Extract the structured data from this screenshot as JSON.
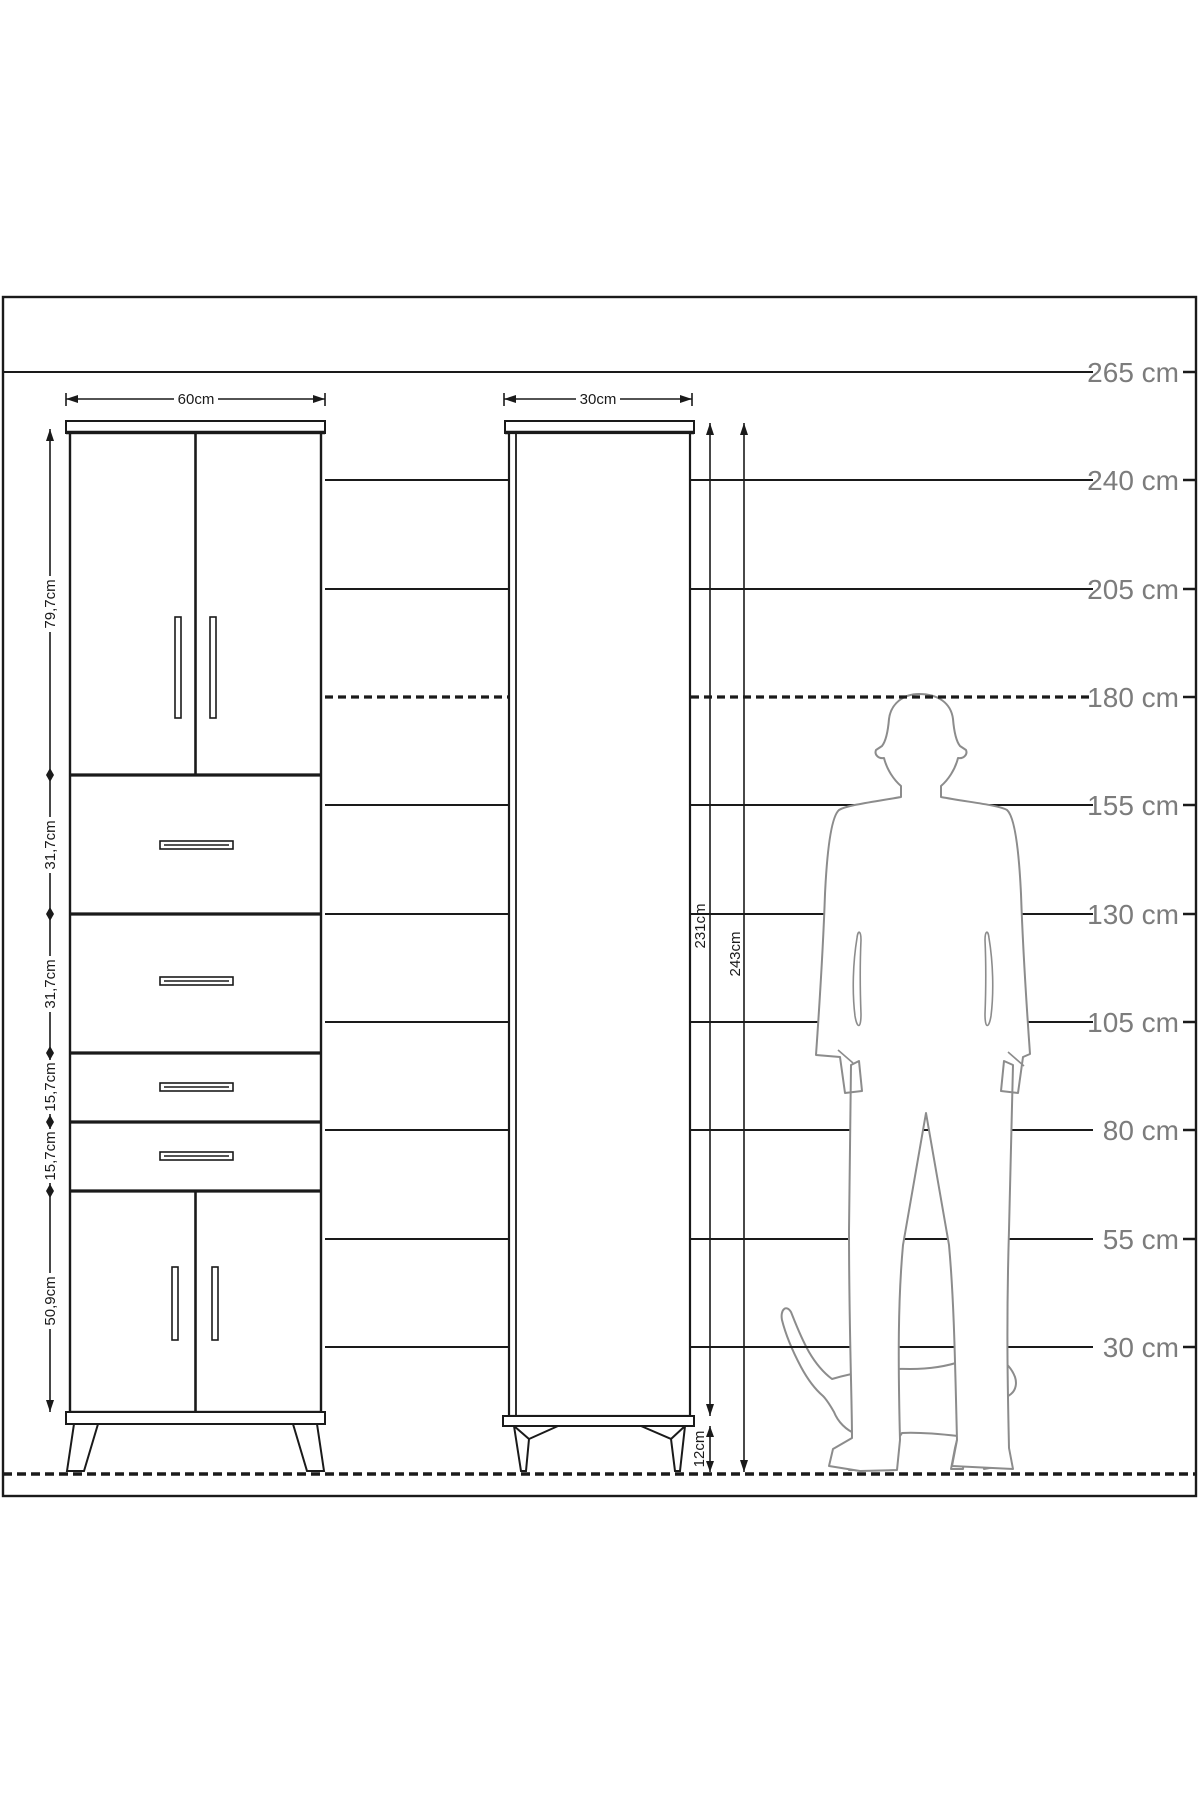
{
  "diagram_title": "cabinet-dimension-scale-drawing",
  "ruler": {
    "unit": "cm",
    "labels": [
      "265 cm",
      "240 cm",
      "205 cm",
      "180 cm",
      "155 cm",
      "130 cm",
      "105 cm",
      "80 cm",
      "55 cm",
      "30 cm"
    ],
    "dashed_level": "180 cm"
  },
  "cabinet_large": {
    "width_label": "60cm",
    "section_labels": [
      "79,7cm",
      "31,7cm",
      "31,7cm",
      "15,7cm",
      "15,7cm",
      "50,9cm"
    ]
  },
  "cabinet_tall": {
    "width_label": "30cm",
    "body_height_label": "231cm",
    "total_height_label": "243cm",
    "leg_height_label": "12cm"
  },
  "figures": {
    "man": "standing man silhouette (180 cm reference)",
    "cat": "walking cat silhouette"
  },
  "colors": {
    "ink": "#1a1a1a",
    "ruler_label": "#7c7c7c",
    "silhouette": "#8c8c8c",
    "background": "#ffffff"
  }
}
